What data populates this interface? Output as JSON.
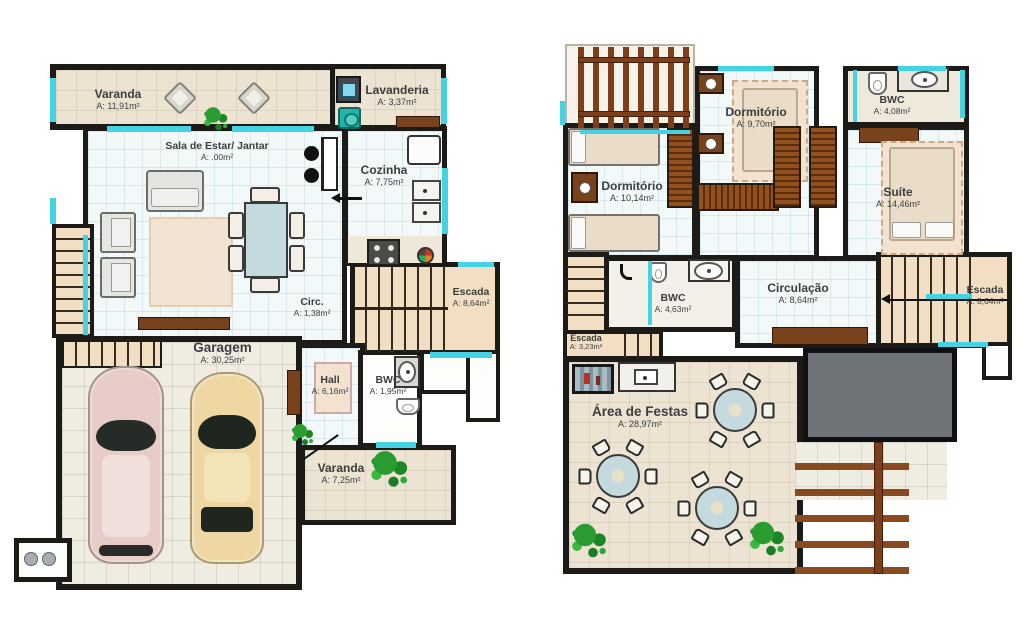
{
  "colors": {
    "wall": "#1d1b18",
    "window": "#43d3e2",
    "floor_tile": "#f3f8f9",
    "floor_beige": "#ece3d3",
    "wood_stair": "#f2dfc3",
    "wood_dark": "#77421c",
    "void_gray": "#6e7378",
    "table_blue": "#c5dade",
    "car_pink": "#e7ccc8",
    "car_beige": "#eed7a2",
    "plant_green": "#2a9c31"
  },
  "floor1": {
    "varanda_top": {
      "name": "Varanda",
      "area": "A: 11,91m²"
    },
    "lavanderia": {
      "name": "Lavanderia",
      "area": "A: 3,37m²"
    },
    "sala": {
      "name": "Sala de Estar/ Jantar",
      "area": "A: .00m²"
    },
    "cozinha": {
      "name": "Cozinha",
      "area": "A: 7,75m²"
    },
    "circ": {
      "name": "Circ.",
      "area": "A: 1,38m²"
    },
    "escada": {
      "name": "Escada",
      "area": "A: 8,64m²"
    },
    "garagem": {
      "name": "Garagem",
      "area": "A: 30,25m²"
    },
    "hall": {
      "name": "Hall",
      "area": "A: 6,16m²"
    },
    "bwc": {
      "name": "BWC",
      "area": "A: 1,95m²"
    },
    "varanda_bottom": {
      "name": "Varanda",
      "area": "A: 7,25m²"
    }
  },
  "floor2": {
    "dormitorio_top": {
      "name": "Dormitório",
      "area": "A: 9,70m²"
    },
    "bwc_top": {
      "name": "BWC",
      "area": "A: 4,08m²"
    },
    "suite": {
      "name": "Suíte",
      "area": "A: 14,46m²"
    },
    "dormitorio_left": {
      "name": "Dormitório",
      "area": "A: 10,14m²"
    },
    "bwc_mid": {
      "name": "BWC",
      "area": "A: 4,63m²"
    },
    "circulacao": {
      "name": "Circulação",
      "area": "A: 8,64m²"
    },
    "escada_right": {
      "name": "Escada",
      "area": "A: 8,64m²"
    },
    "escada_left": {
      "name": "Escada",
      "area": "A: 3,23m²"
    },
    "area_festas": {
      "name": "Área de Festas",
      "area": "A: 28,97m²"
    }
  }
}
